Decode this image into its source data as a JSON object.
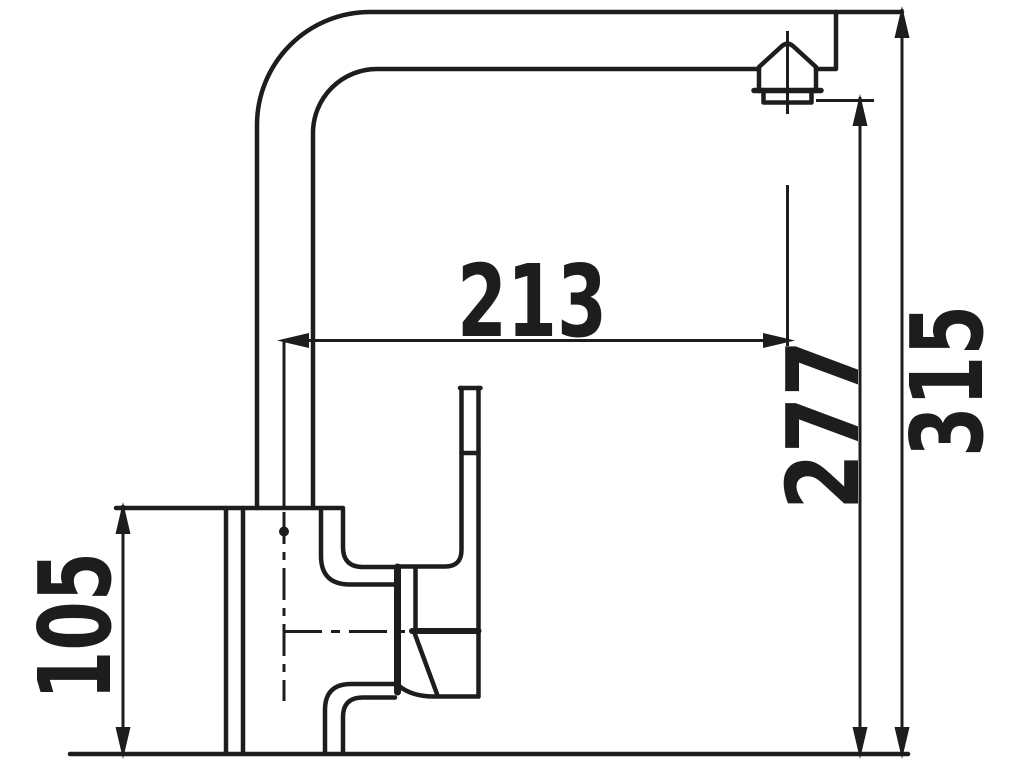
{
  "drawing": {
    "type": "technical-dimension-drawing",
    "subject": "kitchen faucet side view",
    "background_color": "#ffffff",
    "line_color": "#1d1d1b",
    "dimensions": {
      "horizontal_reach": "213",
      "outlet_height": "277",
      "total_height": "315",
      "body_height": "105"
    }
  }
}
